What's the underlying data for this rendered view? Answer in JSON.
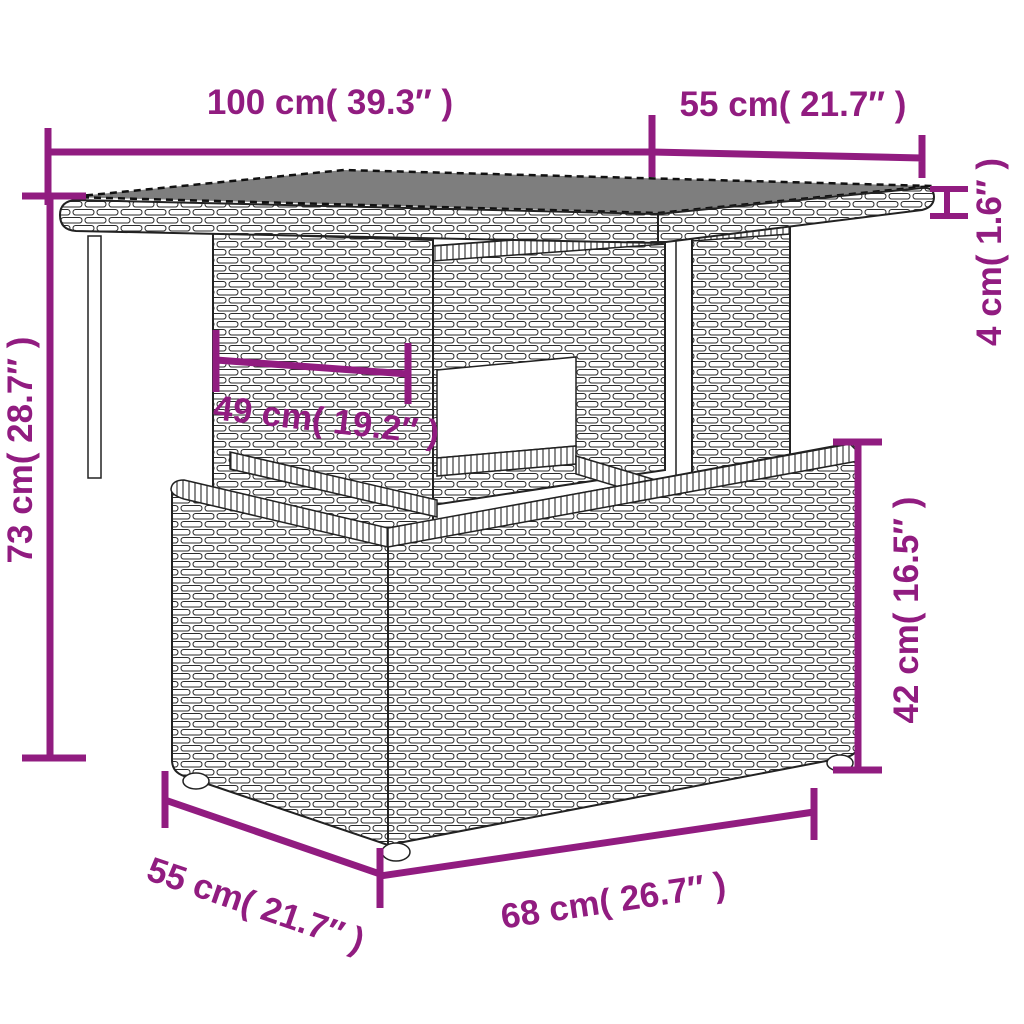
{
  "diagram": {
    "title": "Garden table dimension diagram",
    "subject": "poly rattan garden table with glass top and storage box",
    "accent_color": "#911C80",
    "line_color": "#222222",
    "glass_color": "#7E7E7E",
    "background_color": "#FFFFFF",
    "dimensions": {
      "top_width": {
        "label": "100 cm( 39.3″ )",
        "value_cm": 100,
        "value_in": 39.3
      },
      "top_depth": {
        "label": "55 cm( 21.7″ )",
        "value_cm": 55,
        "value_in": 21.7
      },
      "top_thickness": {
        "label": "4 cm( 1.6″ )",
        "value_cm": 4,
        "value_in": 1.6
      },
      "total_height": {
        "label": "73 cm( 28.7″ )",
        "value_cm": 73,
        "value_in": 28.7
      },
      "clearance": {
        "label": "49 cm( 19.2″ )",
        "value_cm": 49,
        "value_in": 19.2
      },
      "box_height": {
        "label": "42 cm( 16.5″ )",
        "value_cm": 42,
        "value_in": 16.5
      },
      "box_width": {
        "label": "68 cm( 26.7″ )",
        "value_cm": 68,
        "value_in": 26.7
      },
      "box_depth": {
        "label": "55 cm( 21.7″ )",
        "value_cm": 55,
        "value_in": 21.7
      }
    }
  }
}
